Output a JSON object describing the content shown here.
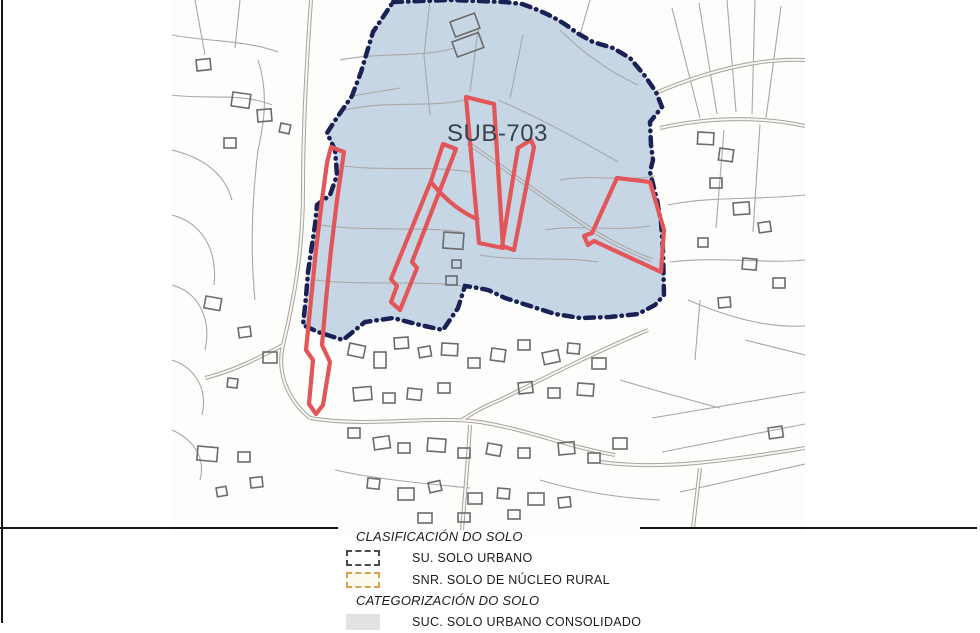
{
  "map": {
    "zone_label": "SUB-703",
    "zone_fill": "#c7d6e4",
    "zone_border_color": "#1a2155",
    "delimitation_color": "#e25558",
    "parcel_line_color": "#a9a7a5",
    "building_line_color": "#6b6b6b",
    "label_color": "#39404e"
  },
  "legend": {
    "section1_title": "CLASIFICACIÓN DO SOLO",
    "items1": [
      {
        "code": "SU",
        "label": "SU. SOLO URBANO",
        "swatch_border": "#4b4b4b",
        "swatch_fill": "#ffffff",
        "border_style": "dashed"
      },
      {
        "code": "SNR",
        "label": "SNR. SOLO DE NÚCLEO RURAL",
        "swatch_border": "#d2a24c",
        "swatch_fill": "#fdfaf0",
        "border_style": "dashed"
      }
    ],
    "section2_title": "CATEGORIZACIÓN DO SOLO",
    "items2": [
      {
        "code": "SUC",
        "label": "SUC. SOLO URBANO CONSOLIDADO",
        "swatch_border": "none",
        "swatch_fill": "#e3e1e1",
        "border_style": "solid"
      }
    ]
  }
}
